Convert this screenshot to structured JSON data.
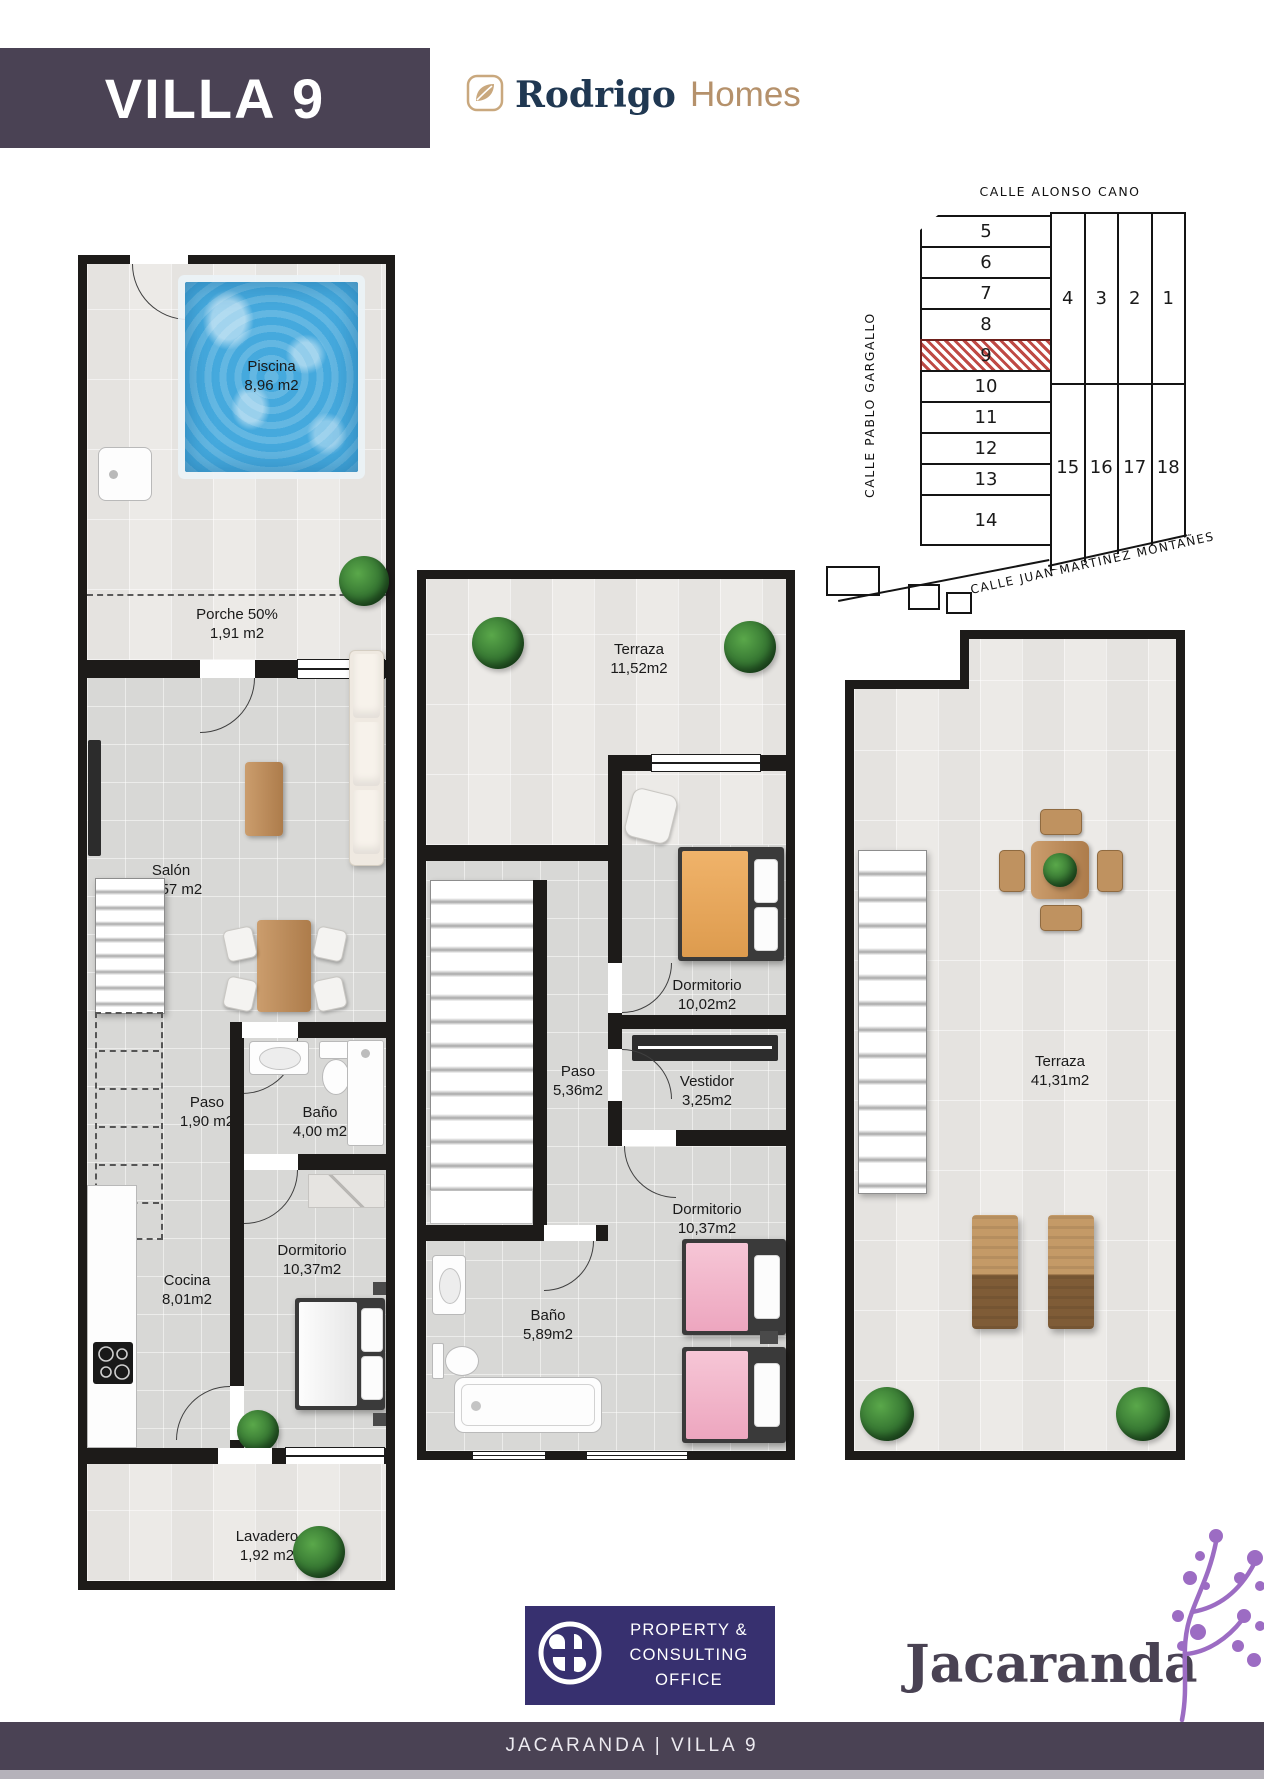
{
  "header": {
    "title": "VILLA 9",
    "brand": {
      "primary": "Rodrigo",
      "secondary": "Homes"
    }
  },
  "site_plan": {
    "street_top": "CALLE ALONSO CANO",
    "street_left": "CALLE PABLO GARGALLO",
    "street_bottom": "CALLE JUAN MARTINEZ MONTAÑES",
    "highlighted_plot": "9",
    "left_plots": [
      "5",
      "6",
      "7",
      "8",
      "9",
      "10",
      "11",
      "12",
      "13",
      "14"
    ],
    "top_right_plots": [
      "4",
      "3",
      "2",
      "1"
    ],
    "bottom_right_plots": [
      "15",
      "16",
      "17",
      "18"
    ]
  },
  "floors": {
    "ground": {
      "rooms": {
        "piscina": {
          "name": "Piscina",
          "area": "8,96 m2"
        },
        "porche": {
          "name": "Porche 50%",
          "area": "1,91 m2"
        },
        "salon": {
          "name": "Salón",
          "area": "22,57 m2"
        },
        "paso": {
          "name": "Paso",
          "area": "1,90 m2"
        },
        "bano": {
          "name": "Baño",
          "area": "4,00 m2"
        },
        "dormitorio": {
          "name": "Dormitorio",
          "area": "10,37m2"
        },
        "cocina": {
          "name": "Cocina",
          "area": "8,01m2"
        },
        "lavadero": {
          "name": "Lavadero",
          "area": "1,92 m2"
        }
      }
    },
    "first": {
      "rooms": {
        "terraza": {
          "name": "Terraza",
          "area": "11,52m2"
        },
        "dormitorio1": {
          "name": "Dormitorio",
          "area": "10,02m2"
        },
        "paso": {
          "name": "Paso",
          "area": "5,36m2"
        },
        "vestidor": {
          "name": "Vestidor",
          "area": "3,25m2"
        },
        "bano": {
          "name": "Baño",
          "area": "5,89m2"
        },
        "dormitorio2": {
          "name": "Dormitorio",
          "area": "10,37m2"
        }
      }
    },
    "roof": {
      "rooms": {
        "terraza": {
          "name": "Terraza",
          "area": "41,31m2"
        }
      }
    }
  },
  "branding": {
    "consulting_lines": [
      "PROPERTY &",
      "CONSULTING",
      "OFFICE"
    ],
    "agency": "Jacaranda"
  },
  "footer": {
    "text": "JACARANDA | VILLA 9"
  },
  "colors": {
    "banner": "#4a4254",
    "footer": "#4a4254",
    "consulting_bg": "#37306f",
    "brand_navy": "#203852",
    "brand_tan": "#b5916b",
    "agency_purple": "#9c6cc3",
    "plot_highlight": "#bf4a45",
    "pool_blue": "#45a9dd"
  }
}
